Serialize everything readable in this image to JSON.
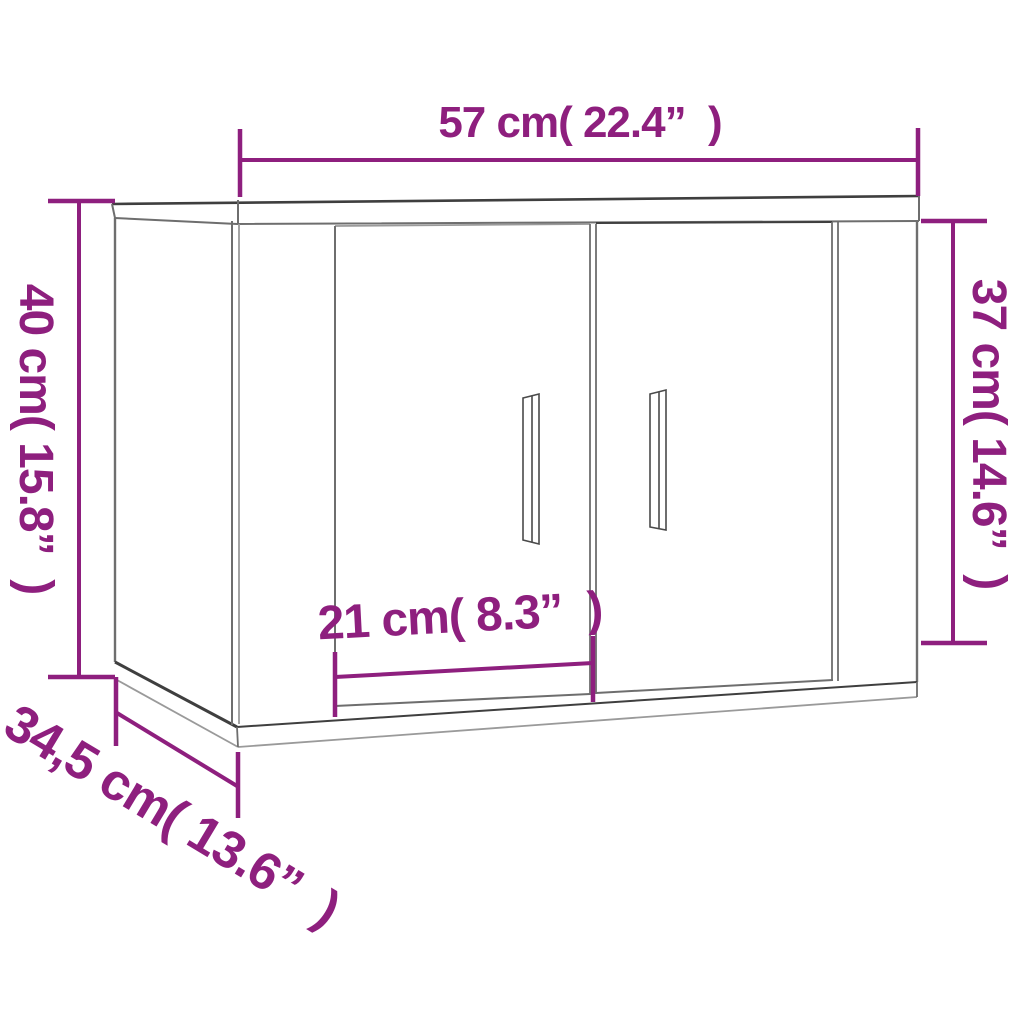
{
  "colors": {
    "dimension_accent": "#8e1f7e",
    "outline_main": "#6e6e6e",
    "outline_dark": "#3f3f3f",
    "background": "#ffffff"
  },
  "dimensions": {
    "width": {
      "cm": "57",
      "inch": "22.4",
      "label": "57 cm( 22.4”  )"
    },
    "height_left": {
      "cm": "40",
      "inch": "15.8",
      "label": "40 cm( 15.8”  )"
    },
    "height_right": {
      "cm": "37",
      "inch": "14.6",
      "label": "37 cm( 14.6”  )"
    },
    "door_width": {
      "cm": "21",
      "inch": "8.3",
      "label": "21 cm( 8.3”  )"
    },
    "depth": {
      "cm": "34,5",
      "inch": "13.6",
      "label": "34,5 cm( 13.6”  )"
    }
  }
}
